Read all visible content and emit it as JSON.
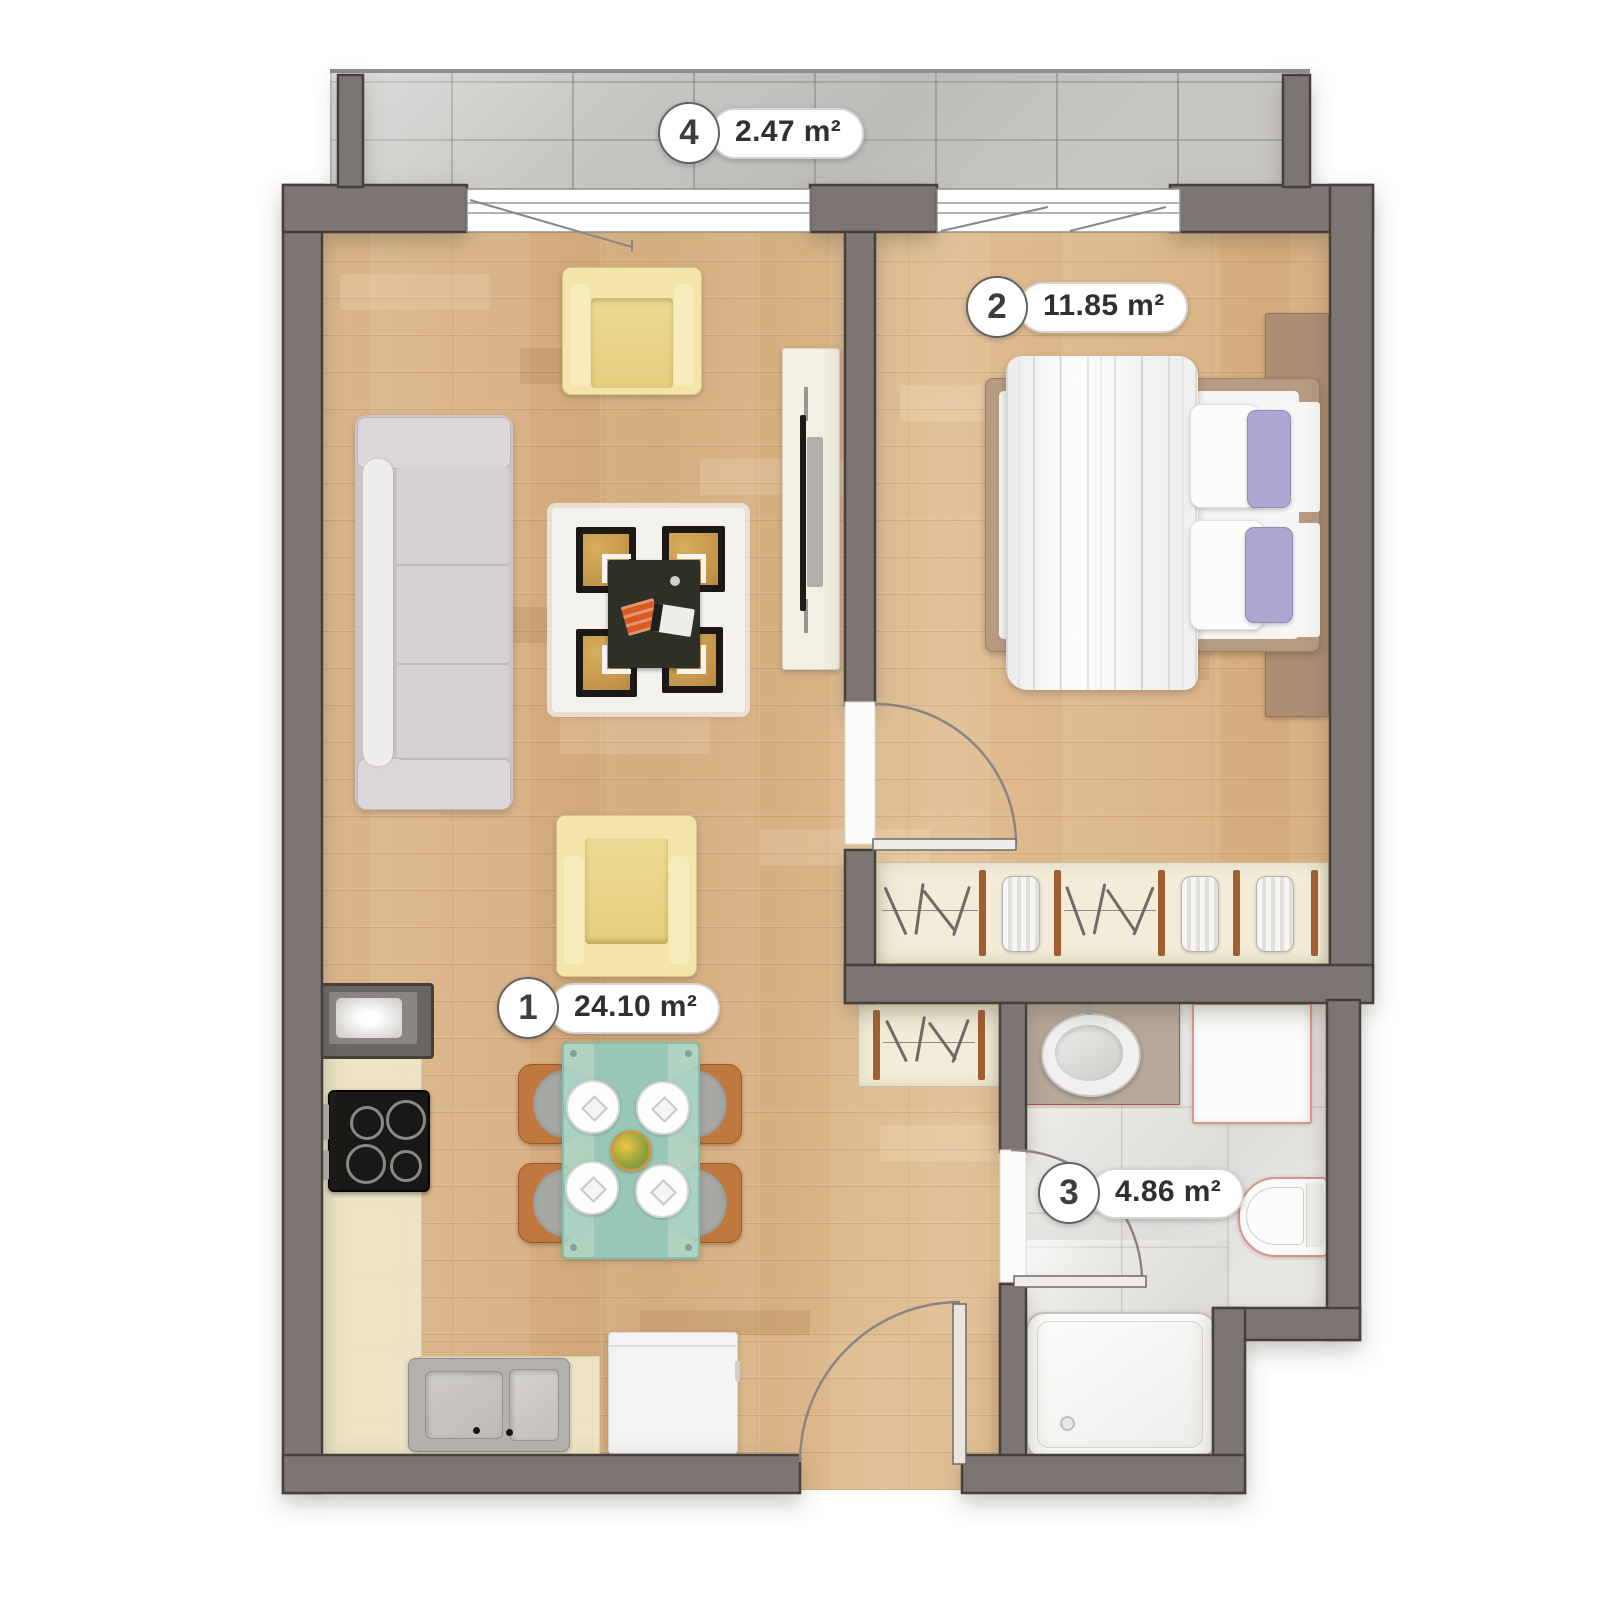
{
  "plan": {
    "type": "apartment-floor-plan",
    "rooms": [
      {
        "number": "1",
        "area": "24.10 m²",
        "name": "living-room-kitchen"
      },
      {
        "number": "2",
        "area": "11.85 m²",
        "name": "bedroom"
      },
      {
        "number": "3",
        "area": "4.86 m²",
        "name": "bathroom"
      },
      {
        "number": "4",
        "area": "2.47 m²",
        "name": "balcony"
      }
    ],
    "colors": {
      "wall": "#7d7573",
      "wall_outline": "#45403d",
      "wood_floor": "#d8b286",
      "balcony_tile": "#c8c6c3",
      "bathroom_tile": "#e9e7e3",
      "rug_gold": "#c4954a",
      "armchair_yellow": "#f3e5a9",
      "glass_table": "#add9cb",
      "pillow_purple": "#b0a6d3",
      "label_text": "#3d3d3d"
    }
  }
}
